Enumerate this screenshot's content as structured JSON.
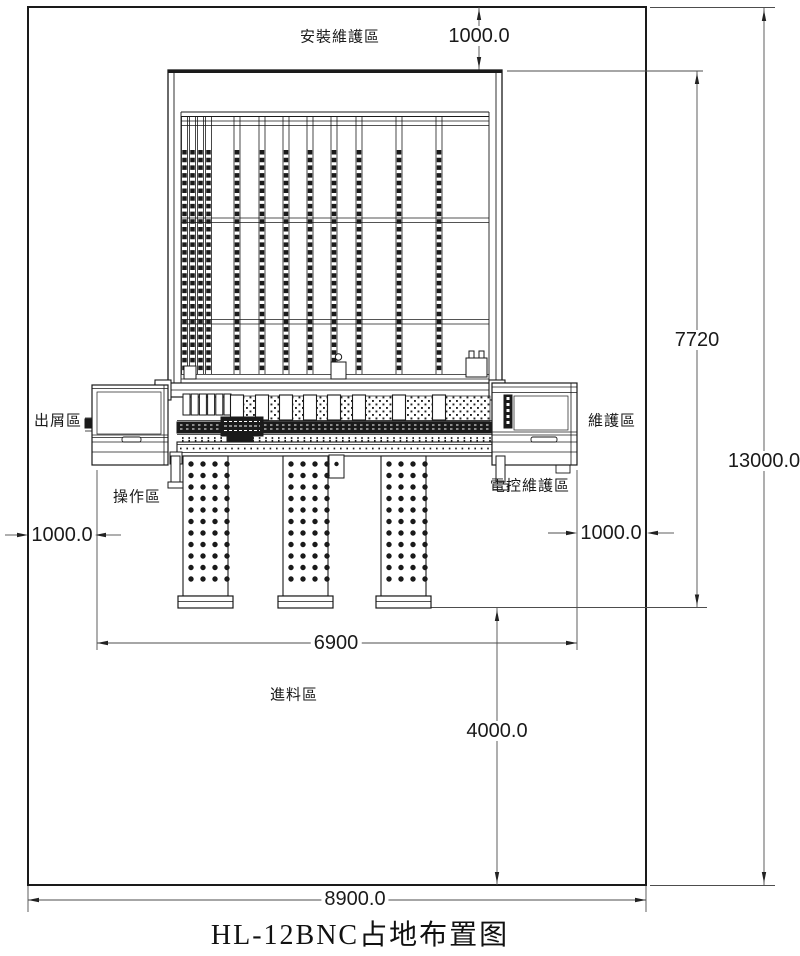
{
  "title": "HL-12BNC占地布置图",
  "zones": {
    "install_maintenance": "安裝維護區",
    "chip_discharge": "出屑區",
    "operation": "操作區",
    "maintenance": "維護區",
    "electrical_maintenance": "電控維護區",
    "feeding": "進料區"
  },
  "dimensions": {
    "top_clearance": "1000.0",
    "machine_depth": "7720",
    "total_depth": "13000.0",
    "left_clearance": "1000.0",
    "right_clearance": "1000.0",
    "machine_width": "6900",
    "front_clearance": "4000.0",
    "total_width": "8900.0"
  },
  "colors": {
    "drawing_line": "#1a1a1a",
    "dimension_line": "#4d4d4d",
    "background": "#ffffff"
  }
}
